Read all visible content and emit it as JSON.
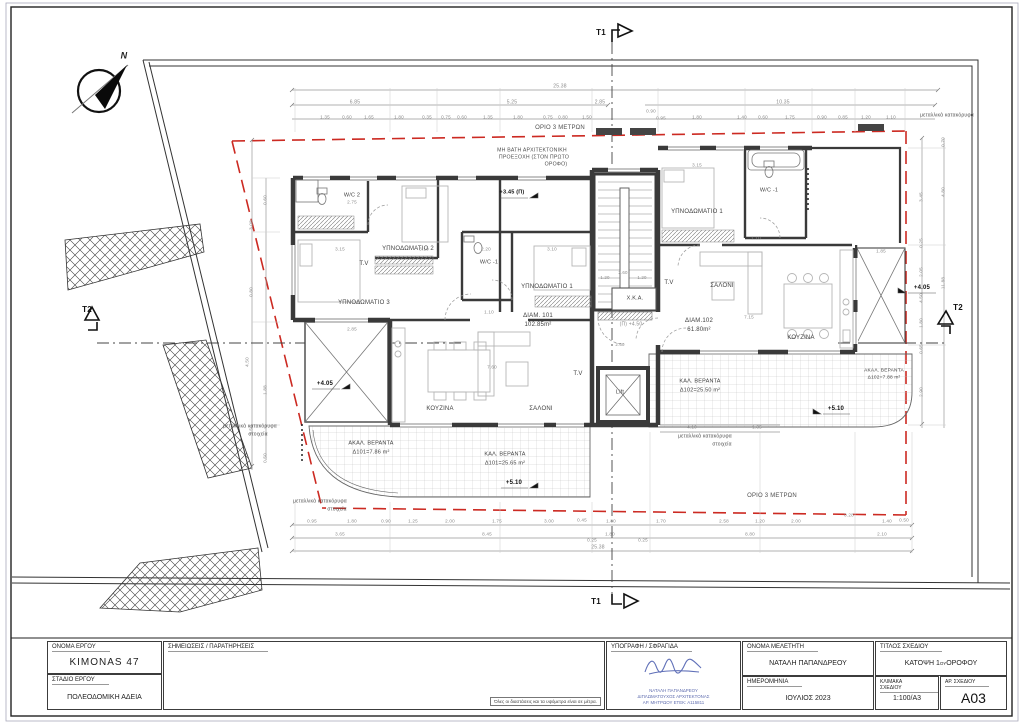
{
  "tb": {
    "project_label": "ΟΝΟΜΑ ΕΡΓΟΥ",
    "project_name": "KIMONAS 47",
    "stage_label": "ΣΤΑΔΙΟ ΕΡΓΟΥ",
    "stage": "ΠΟΛΕΟΔΟΜΙΚΗ ΑΔΕΙΑ",
    "notes_label": "ΣΗΜΕΙΩΣΕΙΣ / ΠΑΡΑΤΗΡΗΣΕΙΣ",
    "notes_footnote": "Όλες οι διαστάσεις και τα υψόμετρα είναι σε μέτρα.",
    "signature_label": "ΥΠΟΓΡΑΦΗ / ΣΦΡΑΓΙΔΑ",
    "stamp_name": "ΝΑΤΑΛΗ ΠΑΠΑΝΔΡΕΟΥ",
    "stamp_title": "ΔΙΠΛΩΜΑΤΟΥΧΟΣ ΑΡΧΙΤΕΚΤΟΝΑΣ",
    "stamp_reg": "ΑΡ. ΜΗΤΡΩΟΥ ΕΤΕΚ: Α115811",
    "designer_label": "ΟΝΟΜΑ ΜΕΛΕΤΗΤΗ",
    "designer": "ΝΑΤΑΛΗ ΠΑΠΑΝΔΡΕΟΥ",
    "date_label": "ΗΜΕΡΟΜΗΝΙΑ",
    "date": "ΙΟΥΛΙΟΣ 2023",
    "title_label": "ΤΙΤΛΟΣ ΣΧΕΔΙΟΥ",
    "title_1": "ΚΑΤΟΨΗ 1",
    "title_sup": "ΟΥ",
    "title_2": " ΟΡΟΦΟΥ",
    "scale_label": "ΚΛΙΜΑΚΑ ΣΧΕΔΙΟΥ",
    "scale": "1:100/Α3",
    "number_label": "ΑΡ. ΣΧΕΔΙΟΥ",
    "number": "A03"
  },
  "plan": {
    "colors": {
      "setback_red": "#cc2a22",
      "wall": "#3a3a3a",
      "dim_gray": "#8a8a8a",
      "stamp_blue": "#5f6daf"
    },
    "texts": [
      {
        "t": "W/C 2",
        "x": 352,
        "y": 196,
        "s": 5.5
      },
      {
        "t": "ΥΠΝΟΔΩΜΑΤΙΟ 2",
        "x": 408,
        "y": 249,
        "s": 6
      },
      {
        "t": "T.V",
        "x": 364,
        "y": 264,
        "s": 6
      },
      {
        "t": "W/C -1",
        "x": 489,
        "y": 263,
        "s": 5.5
      },
      {
        "t": "ΥΠΝΟΔΩΜΑΤΙΟ 3",
        "x": 364,
        "y": 303,
        "s": 6
      },
      {
        "t": "ΥΠΝΟΔΩΜΑΤΙΟ 1",
        "x": 547,
        "y": 287,
        "s": 6
      },
      {
        "t": "ΔΙΑΜ. 101",
        "x": 538,
        "y": 316,
        "s": 6
      },
      {
        "t": "102.85m²",
        "x": 538,
        "y": 325,
        "s": 6
      },
      {
        "t": "ΚΟΥΖΙΝΑ",
        "x": 440,
        "y": 409,
        "s": 6
      },
      {
        "t": "ΣΑΛΟΝΙ",
        "x": 541,
        "y": 409,
        "s": 6
      },
      {
        "t": "T.V",
        "x": 578,
        "y": 374,
        "s": 6
      },
      {
        "t": "Χ.Κ.Α.",
        "x": 635,
        "y": 299,
        "s": 5.5
      },
      {
        "t": "(Π) +4.50",
        "x": 631,
        "y": 325,
        "s": 5,
        "c": "dim"
      },
      {
        "t": "Lift",
        "x": 620,
        "y": 393,
        "s": 5.5
      },
      {
        "t": "ΥΠΝΟΔΩΜΑΤΙΟ 1",
        "x": 697,
        "y": 212,
        "s": 6
      },
      {
        "t": "W/C -1",
        "x": 769,
        "y": 191,
        "s": 5.5
      },
      {
        "t": "T.V",
        "x": 669,
        "y": 283,
        "s": 6
      },
      {
        "t": "ΣΑΛΟΝΙ",
        "x": 722,
        "y": 286,
        "s": 6
      },
      {
        "t": "ΔΙΑΜ.102",
        "x": 699,
        "y": 321,
        "s": 6
      },
      {
        "t": "61.80m²",
        "x": 699,
        "y": 330,
        "s": 6
      },
      {
        "t": "ΚΟΥΖΙΝΑ",
        "x": 801,
        "y": 338,
        "s": 6
      },
      {
        "t": "ΑΚΑΛ. ΒΕΡΑΝΤΑ",
        "x": 371,
        "y": 444,
        "s": 5.5
      },
      {
        "t": "Δ101=7.86 m²",
        "x": 371,
        "y": 453,
        "s": 5.5
      },
      {
        "t": "ΚΑΛ. ΒΕΡΑΝΤΑ",
        "x": 505,
        "y": 455,
        "s": 5.5
      },
      {
        "t": "Δ101=25.65 m²",
        "x": 505,
        "y": 464,
        "s": 5.5
      },
      {
        "t": "ΚΑΛ. ΒΕΡΑΝΤΑ",
        "x": 700,
        "y": 382,
        "s": 5.5
      },
      {
        "t": "Δ102=25.50 m²",
        "x": 700,
        "y": 391,
        "s": 5.5
      },
      {
        "t": "ΑΚΑΛ. ΒΕΡΑΝΤΑ",
        "x": 884,
        "y": 372,
        "s": 4.8
      },
      {
        "t": "Δ102=7.88 m²",
        "x": 884,
        "y": 379,
        "s": 4.8
      },
      {
        "t": "+3.45 (Π)",
        "x": 512,
        "y": 193,
        "s": 5.5,
        "c": "lvl"
      },
      {
        "t": "+4.05",
        "x": 325,
        "y": 384,
        "s": 6,
        "c": "lvl"
      },
      {
        "t": "+4.05",
        "x": 922,
        "y": 288,
        "s": 6,
        "c": "lvl"
      },
      {
        "t": "+5.10",
        "x": 514,
        "y": 483,
        "s": 6,
        "c": "lvl"
      },
      {
        "t": "+5.10",
        "x": 836,
        "y": 409,
        "s": 6,
        "c": "lvl"
      },
      {
        "t": "ΜΗ ΒΑΤΗ ΑΡΧΙΤΕΚΤΟΝΙΚΗ",
        "x": 532,
        "y": 151,
        "s": 5.2,
        "c": "note"
      },
      {
        "t": "ΠΡΟΕΞΟΧΗ (ΣΤΟΝ ΠΡΩΤΟ",
        "x": 534,
        "y": 158,
        "s": 5.2,
        "c": "note"
      },
      {
        "t": "ΟΡΟΦΟ)",
        "x": 556,
        "y": 165,
        "s": 5.2,
        "c": "note"
      },
      {
        "t": "ΟΡΙΟ 3 ΜΕΤΡΩΝ",
        "x": 560,
        "y": 128,
        "s": 6,
        "c": "note"
      },
      {
        "t": "ΟΡΙΟ 3 ΜΕΤΡΩΝ",
        "x": 772,
        "y": 496,
        "s": 6,
        "c": "note"
      },
      {
        "t": "μεταλλικά κατακόρυφα",
        "x": 947,
        "y": 116,
        "s": 5,
        "c": "note"
      },
      {
        "t": "μεταλλικά κατακόρυφα",
        "x": 320,
        "y": 502,
        "s": 5,
        "c": "note"
      },
      {
        "t": "στοιχεία",
        "x": 337,
        "y": 510,
        "s": 5,
        "c": "note"
      },
      {
        "t": "μεταλλικά κατακόρυφα",
        "x": 705,
        "y": 437,
        "s": 5,
        "c": "note"
      },
      {
        "t": "στοιχεία",
        "x": 722,
        "y": 445,
        "s": 5,
        "c": "note"
      },
      {
        "t": "μεταλλικά κατακόρυφα",
        "x": 250,
        "y": 427,
        "s": 5,
        "c": "note"
      },
      {
        "t": "στοιχεία",
        "x": 258,
        "y": 435,
        "s": 5,
        "c": "note"
      },
      {
        "t": "T1",
        "x": 601,
        "y": 33,
        "s": 8,
        "c": "mark"
      },
      {
        "t": "T1",
        "x": 596,
        "y": 602,
        "s": 8,
        "c": "mark"
      },
      {
        "t": "T2",
        "x": 87,
        "y": 310,
        "s": 8,
        "c": "mark"
      },
      {
        "t": "T2",
        "x": 958,
        "y": 308,
        "s": 8,
        "c": "mark"
      },
      {
        "t": "N",
        "x": 124,
        "y": 56,
        "s": 9,
        "c": "north"
      },
      {
        "t": "25.38",
        "x": 560,
        "y": 87,
        "s": 5,
        "c": "dim"
      },
      {
        "t": "6.85",
        "x": 355,
        "y": 103,
        "s": 5,
        "c": "dim"
      },
      {
        "t": "5.25",
        "x": 512,
        "y": 103,
        "s": 5,
        "c": "dim"
      },
      {
        "t": "2.85",
        "x": 600,
        "y": 103,
        "s": 5,
        "c": "dim"
      },
      {
        "t": "10.35",
        "x": 783,
        "y": 103,
        "s": 5,
        "c": "dim"
      },
      {
        "t": "1.35",
        "x": 325,
        "y": 118,
        "s": 4.6,
        "c": "dim"
      },
      {
        "t": "0.60",
        "x": 347,
        "y": 118,
        "s": 4.6,
        "c": "dim"
      },
      {
        "t": "1.65",
        "x": 369,
        "y": 118,
        "s": 4.6,
        "c": "dim"
      },
      {
        "t": "1.80",
        "x": 399,
        "y": 118,
        "s": 4.6,
        "c": "dim"
      },
      {
        "t": "0.35",
        "x": 427,
        "y": 118,
        "s": 4.6,
        "c": "dim"
      },
      {
        "t": "0.75",
        "x": 446,
        "y": 118,
        "s": 4.6,
        "c": "dim"
      },
      {
        "t": "0.60",
        "x": 462,
        "y": 118,
        "s": 4.6,
        "c": "dim"
      },
      {
        "t": "1.35",
        "x": 488,
        "y": 118,
        "s": 4.6,
        "c": "dim"
      },
      {
        "t": "1.80",
        "x": 518,
        "y": 118,
        "s": 4.6,
        "c": "dim"
      },
      {
        "t": "0.75",
        "x": 548,
        "y": 118,
        "s": 4.6,
        "c": "dim"
      },
      {
        "t": "0.80",
        "x": 563,
        "y": 118,
        "s": 4.6,
        "c": "dim"
      },
      {
        "t": "1.50",
        "x": 587,
        "y": 118,
        "s": 4.6,
        "c": "dim"
      },
      {
        "t": "0.90",
        "x": 651,
        "y": 112,
        "s": 4.6,
        "c": "dim"
      },
      {
        "t": "0.95",
        "x": 661,
        "y": 119,
        "s": 4.6,
        "c": "dim"
      },
      {
        "t": "1.80",
        "x": 697,
        "y": 118,
        "s": 4.6,
        "c": "dim"
      },
      {
        "t": "1.40",
        "x": 742,
        "y": 118,
        "s": 4.6,
        "c": "dim"
      },
      {
        "t": "0.60",
        "x": 763,
        "y": 118,
        "s": 4.6,
        "c": "dim"
      },
      {
        "t": "1.75",
        "x": 790,
        "y": 118,
        "s": 4.6,
        "c": "dim"
      },
      {
        "t": "0.90",
        "x": 822,
        "y": 118,
        "s": 4.6,
        "c": "dim"
      },
      {
        "t": "0.85",
        "x": 843,
        "y": 118,
        "s": 4.6,
        "c": "dim"
      },
      {
        "t": "1.20",
        "x": 866,
        "y": 118,
        "s": 4.6,
        "c": "dim"
      },
      {
        "t": "1.10",
        "x": 891,
        "y": 118,
        "s": 4.6,
        "c": "dim"
      },
      {
        "t": "0.95",
        "x": 312,
        "y": 522,
        "s": 4.6,
        "c": "dim"
      },
      {
        "t": "1.80",
        "x": 352,
        "y": 522,
        "s": 4.6,
        "c": "dim"
      },
      {
        "t": "0.90",
        "x": 386,
        "y": 522,
        "s": 4.6,
        "c": "dim"
      },
      {
        "t": "1.25",
        "x": 413,
        "y": 522,
        "s": 4.6,
        "c": "dim"
      },
      {
        "t": "2.00",
        "x": 450,
        "y": 522,
        "s": 4.6,
        "c": "dim"
      },
      {
        "t": "1.75",
        "x": 497,
        "y": 522,
        "s": 4.6,
        "c": "dim"
      },
      {
        "t": "3.00",
        "x": 549,
        "y": 522,
        "s": 4.6,
        "c": "dim"
      },
      {
        "t": "0.45",
        "x": 582,
        "y": 521,
        "s": 4.6,
        "c": "dim"
      },
      {
        "t": "1.80",
        "x": 611,
        "y": 522,
        "s": 4.6,
        "c": "dim"
      },
      {
        "t": "1.70",
        "x": 661,
        "y": 522,
        "s": 4.6,
        "c": "dim"
      },
      {
        "t": "2.58",
        "x": 724,
        "y": 522,
        "s": 4.6,
        "c": "dim"
      },
      {
        "t": "1.20",
        "x": 760,
        "y": 522,
        "s": 4.6,
        "c": "dim"
      },
      {
        "t": "2.00",
        "x": 796,
        "y": 522,
        "s": 4.6,
        "c": "dim"
      },
      {
        "t": "0.28",
        "x": 849,
        "y": 516,
        "s": 4.6,
        "c": "dim"
      },
      {
        "t": "1.40",
        "x": 887,
        "y": 522,
        "s": 4.6,
        "c": "dim"
      },
      {
        "t": "0.50",
        "x": 904,
        "y": 521,
        "s": 4.6,
        "c": "dim"
      },
      {
        "t": "3.65",
        "x": 340,
        "y": 535,
        "s": 4.6,
        "c": "dim"
      },
      {
        "t": "8.45",
        "x": 487,
        "y": 535,
        "s": 4.6,
        "c": "dim"
      },
      {
        "t": "0.25",
        "x": 592,
        "y": 541,
        "s": 4.6,
        "c": "dim"
      },
      {
        "t": "1.80",
        "x": 610,
        "y": 535,
        "s": 4.6,
        "c": "dim"
      },
      {
        "t": "0.25",
        "x": 643,
        "y": 541,
        "s": 4.6,
        "c": "dim"
      },
      {
        "t": "8.80",
        "x": 750,
        "y": 535,
        "s": 4.6,
        "c": "dim"
      },
      {
        "t": "2.10",
        "x": 882,
        "y": 535,
        "s": 4.6,
        "c": "dim"
      },
      {
        "t": "25.38",
        "x": 598,
        "y": 548,
        "s": 5,
        "c": "dim"
      },
      {
        "t": "4.10",
        "x": 692,
        "y": 428,
        "s": 4.6,
        "c": "dim"
      },
      {
        "t": "1.35",
        "x": 757,
        "y": 428,
        "s": 4.6,
        "c": "dim"
      },
      {
        "t": "2.75",
        "x": 352,
        "y": 203,
        "s": 4.6,
        "c": "dim"
      },
      {
        "t": "3.15",
        "x": 340,
        "y": 250,
        "s": 4.6,
        "c": "dim"
      },
      {
        "t": "3.10",
        "x": 424,
        "y": 250,
        "s": 4.6,
        "c": "dim"
      },
      {
        "t": "2.20",
        "x": 486,
        "y": 250,
        "s": 4.6,
        "c": "dim"
      },
      {
        "t": "3.10",
        "x": 552,
        "y": 250,
        "s": 4.6,
        "c": "dim"
      },
      {
        "t": "1.10",
        "x": 489,
        "y": 313,
        "s": 4.6,
        "c": "dim"
      },
      {
        "t": "2.85",
        "x": 352,
        "y": 330,
        "s": 4.6,
        "c": "dim"
      },
      {
        "t": "7.60",
        "x": 492,
        "y": 368,
        "s": 4.6,
        "c": "dim"
      },
      {
        "t": "3.15",
        "x": 697,
        "y": 166,
        "s": 4.6,
        "c": "dim"
      },
      {
        "t": "1.10",
        "x": 756,
        "y": 239,
        "s": 4.6,
        "c": "dim"
      },
      {
        "t": "7.15",
        "x": 749,
        "y": 318,
        "s": 4.6,
        "c": "dim"
      },
      {
        "t": "1.85",
        "x": 881,
        "y": 252,
        "s": 4.6,
        "c": "dim"
      },
      {
        "t": "1.20",
        "x": 605,
        "y": 278,
        "s": 4.4,
        "c": "dim"
      },
      {
        "t": "2.60",
        "x": 623,
        "y": 273,
        "s": 4.4,
        "c": "dim"
      },
      {
        "t": "1.20",
        "x": 642,
        "y": 278,
        "s": 4.4,
        "c": "dim"
      },
      {
        "t": "2.60",
        "x": 620,
        "y": 345,
        "s": 4.4,
        "c": "dim"
      },
      {
        "t": "3.08",
        "x": 252,
        "y": 225,
        "s": 4.6,
        "r": -90,
        "c": "dim"
      },
      {
        "t": "0.80",
        "x": 252,
        "y": 292,
        "s": 4.6,
        "r": -90,
        "c": "dim"
      },
      {
        "t": "4.50",
        "x": 248,
        "y": 362,
        "s": 4.6,
        "r": -90,
        "c": "dim"
      },
      {
        "t": "1.50",
        "x": 252,
        "y": 430,
        "s": 4.6,
        "r": -90,
        "c": "dim"
      },
      {
        "t": "0.60",
        "x": 266,
        "y": 200,
        "s": 4.6,
        "r": -90,
        "c": "dim"
      },
      {
        "t": "1.88",
        "x": 266,
        "y": 390,
        "s": 4.6,
        "r": -90,
        "c": "dim"
      },
      {
        "t": "0.50",
        "x": 266,
        "y": 458,
        "s": 4.6,
        "r": -90,
        "c": "dim"
      },
      {
        "t": "3.45",
        "x": 922,
        "y": 197,
        "s": 4.6,
        "r": -90,
        "c": "dim"
      },
      {
        "t": "0.25",
        "x": 922,
        "y": 243,
        "s": 4.6,
        "r": -90,
        "c": "dim"
      },
      {
        "t": "2.05",
        "x": 922,
        "y": 272,
        "s": 4.6,
        "r": -90,
        "c": "dim"
      },
      {
        "t": "4.50",
        "x": 922,
        "y": 298,
        "s": 4.6,
        "r": -90,
        "c": "dim"
      },
      {
        "t": "1.80",
        "x": 922,
        "y": 323,
        "s": 4.6,
        "r": -90,
        "c": "dim"
      },
      {
        "t": "0.65",
        "x": 922,
        "y": 349,
        "s": 4.6,
        "r": -90,
        "c": "dim"
      },
      {
        "t": "2.90",
        "x": 922,
        "y": 392,
        "s": 4.6,
        "r": -90,
        "c": "dim"
      },
      {
        "t": "0.70",
        "x": 944,
        "y": 142,
        "s": 4.6,
        "r": -90,
        "c": "dim"
      },
      {
        "t": "4.80",
        "x": 944,
        "y": 192,
        "s": 4.6,
        "r": -90,
        "c": "dim"
      },
      {
        "t": "11.88",
        "x": 944,
        "y": 283,
        "s": 4.6,
        "r": -90,
        "c": "dim"
      }
    ]
  }
}
